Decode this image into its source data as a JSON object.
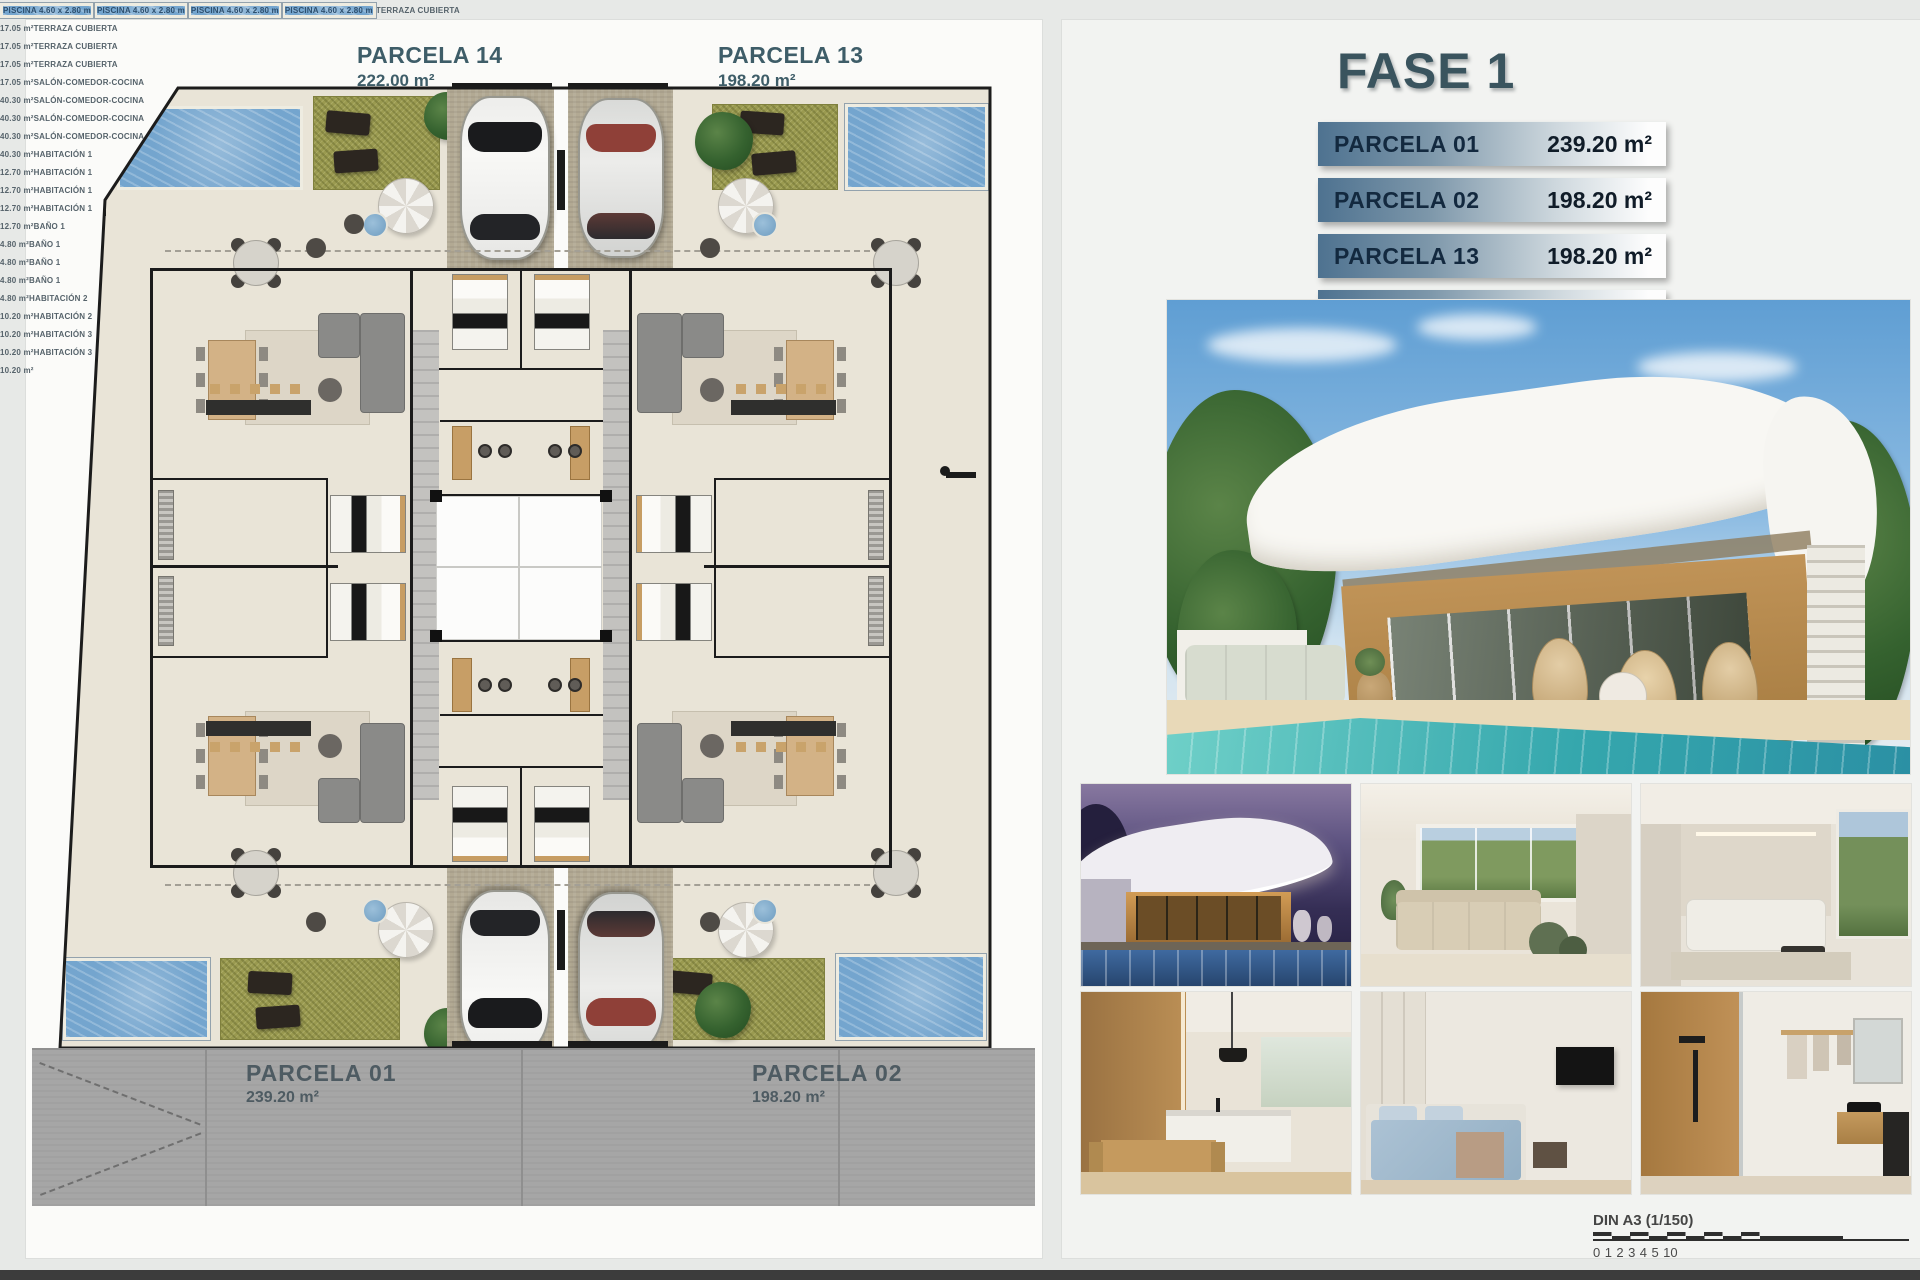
{
  "plan": {
    "top_parcels": [
      {
        "name": "PARCELA 14",
        "area": "222.00 m²"
      },
      {
        "name": "PARCELA 13",
        "area": "198.20 m²"
      }
    ],
    "road_parcels": [
      {
        "name": "PARCELA 01",
        "area": "239.20 m²"
      },
      {
        "name": "PARCELA 02",
        "area": "198.20 m²"
      }
    ],
    "room_labels": [
      {
        "text": "PISCINA 4.60 x 2.80 m",
        "x": 228,
        "y": 114,
        "variant": "pool"
      },
      {
        "text": "PISCINA 4.60 x 2.80 m",
        "x": 912,
        "y": 120,
        "variant": "pool"
      },
      {
        "text": "PISCINA 4.60 x 2.80 m",
        "x": 152,
        "y": 963,
        "variant": "pool"
      },
      {
        "text": "PISCINA 4.60 x 2.80 m",
        "x": 902,
        "y": 960,
        "variant": "pool"
      },
      {
        "text": "TERRAZA CUBIERTA\n17.05 m²",
        "x": 382,
        "y": 291
      },
      {
        "text": "TERRAZA CUBIERTA\n17.05 m²",
        "x": 766,
        "y": 291
      },
      {
        "text": "TERRAZA CUBIERTA\n17.05 m²",
        "x": 382,
        "y": 845
      },
      {
        "text": "TERRAZA CUBIERTA\n17.05 m²",
        "x": 766,
        "y": 845
      },
      {
        "text": "SALÓN-COMEDOR-COCINA\n40.30 m²",
        "x": 415,
        "y": 428
      },
      {
        "text": "SALÓN-COMEDOR-COCINA\n40.30 m²",
        "x": 647,
        "y": 428
      },
      {
        "text": "SALÓN-COMEDOR-COCINA\n40.30 m²",
        "x": 415,
        "y": 708
      },
      {
        "text": "SALÓN-COMEDOR-COCINA\n40.30 m²",
        "x": 647,
        "y": 708
      },
      {
        "text": "HABITACIÓN 1\n12.70 m²",
        "x": 479,
        "y": 366
      },
      {
        "text": "HABITACIÓN 1\n12.70 m²",
        "x": 563,
        "y": 366
      },
      {
        "text": "HABITACIÓN 1\n12.70 m²",
        "x": 479,
        "y": 772
      },
      {
        "text": "HABITACIÓN 1\n12.70 m²",
        "x": 563,
        "y": 772
      },
      {
        "text": "BAÑO 1\n4.80 m²",
        "x": 479,
        "y": 462
      },
      {
        "text": "BAÑO 1\n4.80 m²",
        "x": 563,
        "y": 462
      },
      {
        "text": "BAÑO 1\n4.80 m²",
        "x": 479,
        "y": 676
      },
      {
        "text": "BAÑO 1\n4.80 m²",
        "x": 563,
        "y": 676
      },
      {
        "text": "HABITACIÓN 2\n10.20 m²",
        "x": 352,
        "y": 470
      },
      {
        "text": "HABITACIÓN 2\n10.20 m²",
        "x": 690,
        "y": 470
      },
      {
        "text": "HABITACIÓN 3\n10.20 m²",
        "x": 352,
        "y": 662
      },
      {
        "text": "HABITACIÓN 3\n10.20 m²",
        "x": 690,
        "y": 662
      }
    ]
  },
  "panel": {
    "title": "FASE 1",
    "table": [
      {
        "label": "PARCELA 01",
        "value": "239.20 m²"
      },
      {
        "label": "PARCELA 02",
        "value": "198.20 m²"
      },
      {
        "label": "PARCELA 13",
        "value": "198.20 m²"
      },
      {
        "label": "PARCELA 14",
        "value": "222.00 m²"
      }
    ],
    "scale_bar": {
      "label": "DIN A3 (1/150)",
      "ticks": [
        "0",
        "1",
        "2",
        "3",
        "4",
        "5",
        "10"
      ]
    },
    "renders": {
      "hero": "villa-exterior-day",
      "thumbnails": [
        "villa-exterior-night",
        "living-room",
        "lounge",
        "kitchen-dining",
        "bedroom",
        "bathroom"
      ]
    }
  },
  "colors": {
    "accent_dark": "#3a545e",
    "table_steel": "#54788f",
    "pool_blue": "#74a5ce",
    "grass_green": "#9a9a50",
    "road_gray": "#a6a6a6"
  }
}
